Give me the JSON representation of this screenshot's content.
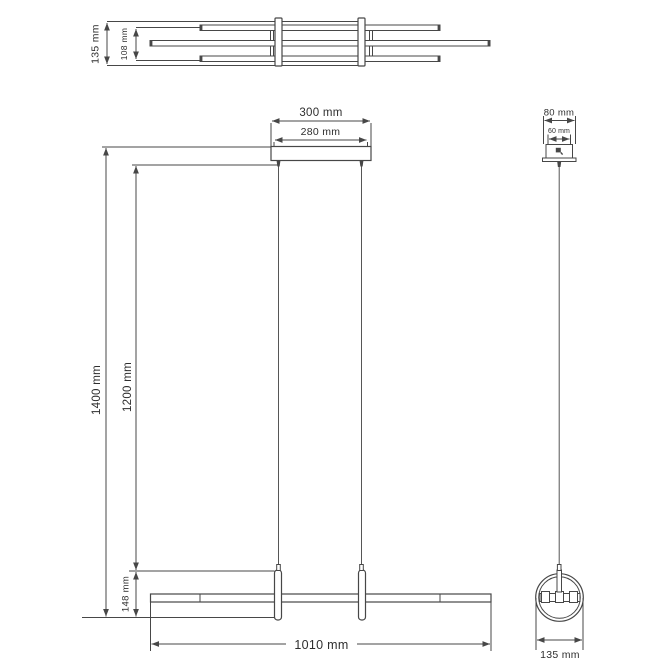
{
  "views": {
    "top": {
      "dims": {
        "depth_total": "135 mm",
        "depth_inner": "108 mm"
      }
    },
    "front": {
      "dims": {
        "canopy_width": "300 mm",
        "suspension_spacing": "280 mm",
        "overall_drop": "1400 mm",
        "cable_drop": "1200 mm",
        "ring_diameter": "148 mm",
        "bar_length": "1010 mm"
      }
    },
    "side": {
      "dims": {
        "canopy_width": "80 mm",
        "canopy_inner": "60 mm",
        "fixture_depth": "135 mm"
      }
    }
  },
  "colors": {
    "line": "#474747",
    "text": "#2e2e2e",
    "background": "#ffffff"
  }
}
